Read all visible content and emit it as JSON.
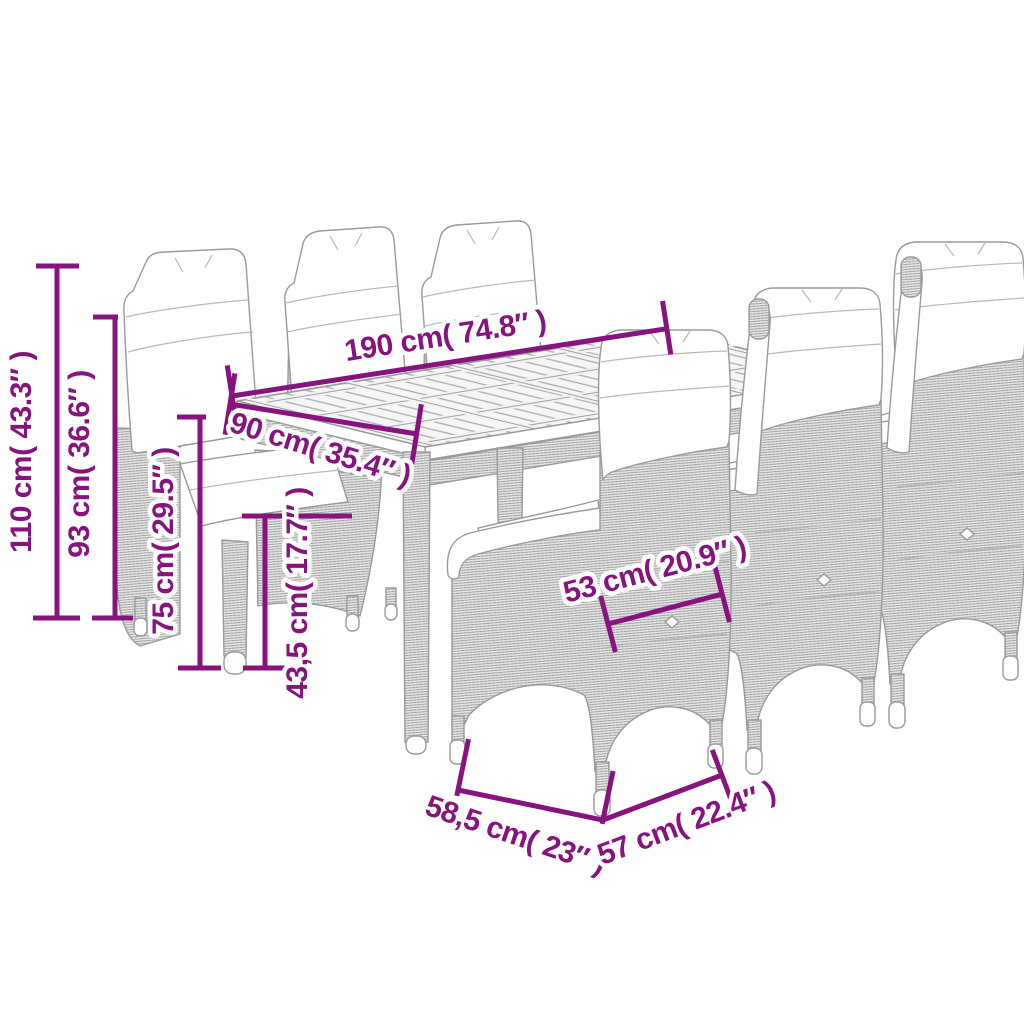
{
  "colors": {
    "accent": "#87137E",
    "line_art": "#9a9a9a"
  },
  "dimensions": {
    "total_height": "110 cm( 43.3″ )",
    "back_height": "93 cm( 36.6″ )",
    "table_height": "75 cm( 29.5″ )",
    "seat_height": "43,5 cm( 17.7″ )",
    "table_length": "190 cm( 74.8″ )",
    "table_width": "90 cm( 35.4″ )",
    "seat_width": "53 cm( 20.9″ )",
    "chair_depth": "58,5 cm( 23″ )",
    "chair_width": "57 cm( 22.4″ )"
  }
}
